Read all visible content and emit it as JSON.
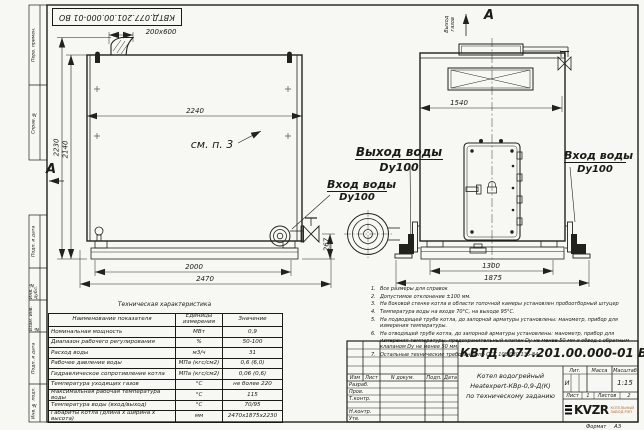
{
  "stamp_top": "КВТД.077.201.00.000-01  ВО",
  "frame": {
    "labels": [
      "Перв. примен.",
      "Справ. №",
      "Подп. и дата",
      "Инв. № дубл.",
      "Взам. инв. №",
      "Подп. и дата",
      "Инв. № подл."
    ],
    "format_label": "Формат",
    "format_value": "А3"
  },
  "drawing": {
    "side_view": {
      "dim_flue": "200x600",
      "dim_width": "2240",
      "dim_height_total": "2230",
      "dim_height_body": "2140",
      "dim_base": "2000",
      "dim_length": "2470",
      "dim_outlet_height": "267",
      "note_ref": "см. п. 3",
      "view_mark": "А"
    },
    "front_view": {
      "view_label": "А",
      "gas_outlet": "Выход\nгазов",
      "dim_width": "1540",
      "dim_base": "1300",
      "dim_full": "1875",
      "inlet_label": "Вход воды",
      "inlet_dy": "Dy100"
    },
    "callouts": {
      "outlet_label": "Выход воды",
      "outlet_dy": "Dy100",
      "inlet_label": "Вход воды",
      "inlet_dy": "Dy100"
    }
  },
  "tech_table": {
    "title": "Техническая характеристика",
    "headers": [
      "Наименование показателя",
      "Единицы измерения",
      "Значение"
    ],
    "rows": [
      [
        "Номинальная мощность",
        "МВт",
        "0,9"
      ],
      [
        "Диапазон рабочего регулирования",
        "%",
        "50-100"
      ],
      [
        "Расход воды",
        "м3/ч",
        "31"
      ],
      [
        "Рабочее давление воды",
        "МПа (кгс/см2)",
        "0,6 (6,0)"
      ],
      [
        "Гидравлическое сопротивление котла",
        "МПа (кгс/см2)",
        "0,06 (0,6)"
      ],
      [
        "Температура уходящих газов",
        "°С",
        "не более 220"
      ],
      [
        "Максимальная рабочая температура воды",
        "°С",
        "115"
      ],
      [
        "Температура воды (вход/выход)",
        "°С",
        "70/95"
      ],
      [
        "Габариты котла (длина х ширина х высота)",
        "мм",
        "2470х1875х2230"
      ]
    ]
  },
  "notes": {
    "items": [
      {
        "num": "1.",
        "text": "Все размеры для справок"
      },
      {
        "num": "2.",
        "text": "Допустимое отклонение ±100 мм."
      },
      {
        "num": "3.",
        "text": "На боковой стенке котла в области топочной камеры установлен пробоотборный штуцер"
      },
      {
        "num": "4.",
        "text": "Температура воды на входе 70°С, на выходе 95°С."
      },
      {
        "num": "5.",
        "text": "На подводящей трубе котла, до запорной арматуры установлены: манометр, прибор для измерения температуры."
      },
      {
        "num": "6.",
        "text": "На отводящей трубе котла, до запорной арматуры установлены: манометр, прибор для измерения температуры, предохранительный клапан Dу не менее 50 мм и обвод с обратным клапаном Dу не менее 50 мм."
      },
      {
        "num": "7.",
        "text": "Остальные технические требования по ОСТ 108.030.135-84"
      }
    ]
  },
  "title_block": {
    "designation": "КВТД .077.201.00.000-01  ВО",
    "name_line1": "Котел водогрейный",
    "name_line2": "Heatexpert-КВр-0,9-Д(К)",
    "name_line3": "по техническому заданию",
    "col_izm": "Изм",
    "col_list": "Лист",
    "col_doc": "N докум.",
    "col_podp": "Подп.",
    "col_data": "Дата",
    "row_razrab": "Разраб.",
    "row_prov": "Пров.",
    "row_tkontr": "Т.контр.",
    "row_nkontr": "Н.контр.",
    "row_utv": "Утв.",
    "lit_label": "Лит.",
    "mass_label": "Масса",
    "scale_label": "Масштаб",
    "lit_value": "И",
    "scale_value": "1:15",
    "sheet_label": "Лист",
    "sheet_value": "1",
    "sheets_label": "Листов",
    "sheets_value": "2",
    "logo_text": "KVZR",
    "logo_sub1": "КОТЕЛЬНЫЙ",
    "logo_sub2": "ЗАВОД РЭП"
  },
  "colors": {
    "line": "#22221c",
    "paper": "#f7f7f3",
    "logo_accent": "#b06a30"
  }
}
